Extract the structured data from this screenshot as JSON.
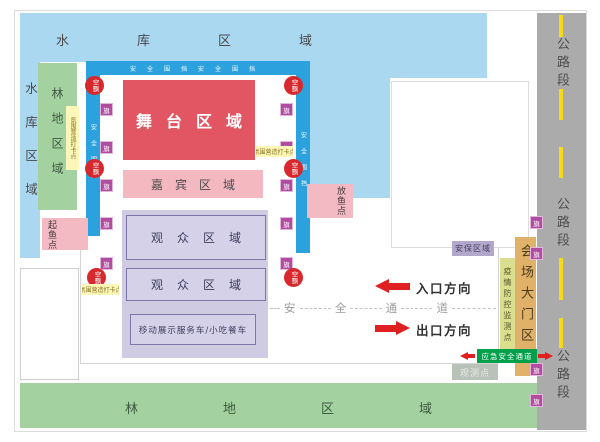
{
  "map": {
    "reservoir": {
      "top_label": "水库区域",
      "left_label": "水库区域"
    },
    "forest": {
      "left_label": "林地区域",
      "bottom_label": "林地区域"
    },
    "venue": {
      "stage_label": "舞台区域",
      "guest_label": "嘉宾区域",
      "audience_label_1": "观众区域",
      "audience_label_2": "观众区域",
      "vehicles_label": "移动展示服务车/小吃餐车"
    },
    "points": {
      "checkin_label": "氛围营造打卡点",
      "fish_release_label": "放鱼点",
      "fish_lift_label": "起鱼点",
      "security_label": "安保区域",
      "epidemic_label": "疫情防控监测点",
      "gate_label": "会场大门区域",
      "emergency_label": "应急安全通道",
      "observation_label": "观测点"
    },
    "circulation": {
      "entrance_label": "入口方向",
      "exit_label": "出口方向",
      "safety_chars": [
        "安",
        "全",
        "通",
        "道"
      ]
    },
    "road": {
      "segment_label": "公路段"
    },
    "badges": {
      "flag": "旗",
      "balloon": "空飘",
      "fence": "安全围挡"
    },
    "colors": {
      "water": "#a9d8f0",
      "forest": "#a3d1a0",
      "stage_red": "#e25663",
      "guest_pink": "#f4b8c1",
      "audience_purple": "#cecbe3",
      "fence_blue": "#2ba1dd",
      "road_gray": "#ababab",
      "road_line_yellow": "#f6d919",
      "gate_tan": "#e0b168",
      "epidemic_strip_green": "#dadf90",
      "emergency_green": "#00a04a",
      "balloon_red": "#d7282e",
      "flag_purple": "#b14da1",
      "arrow_red": "#e02020"
    }
  }
}
